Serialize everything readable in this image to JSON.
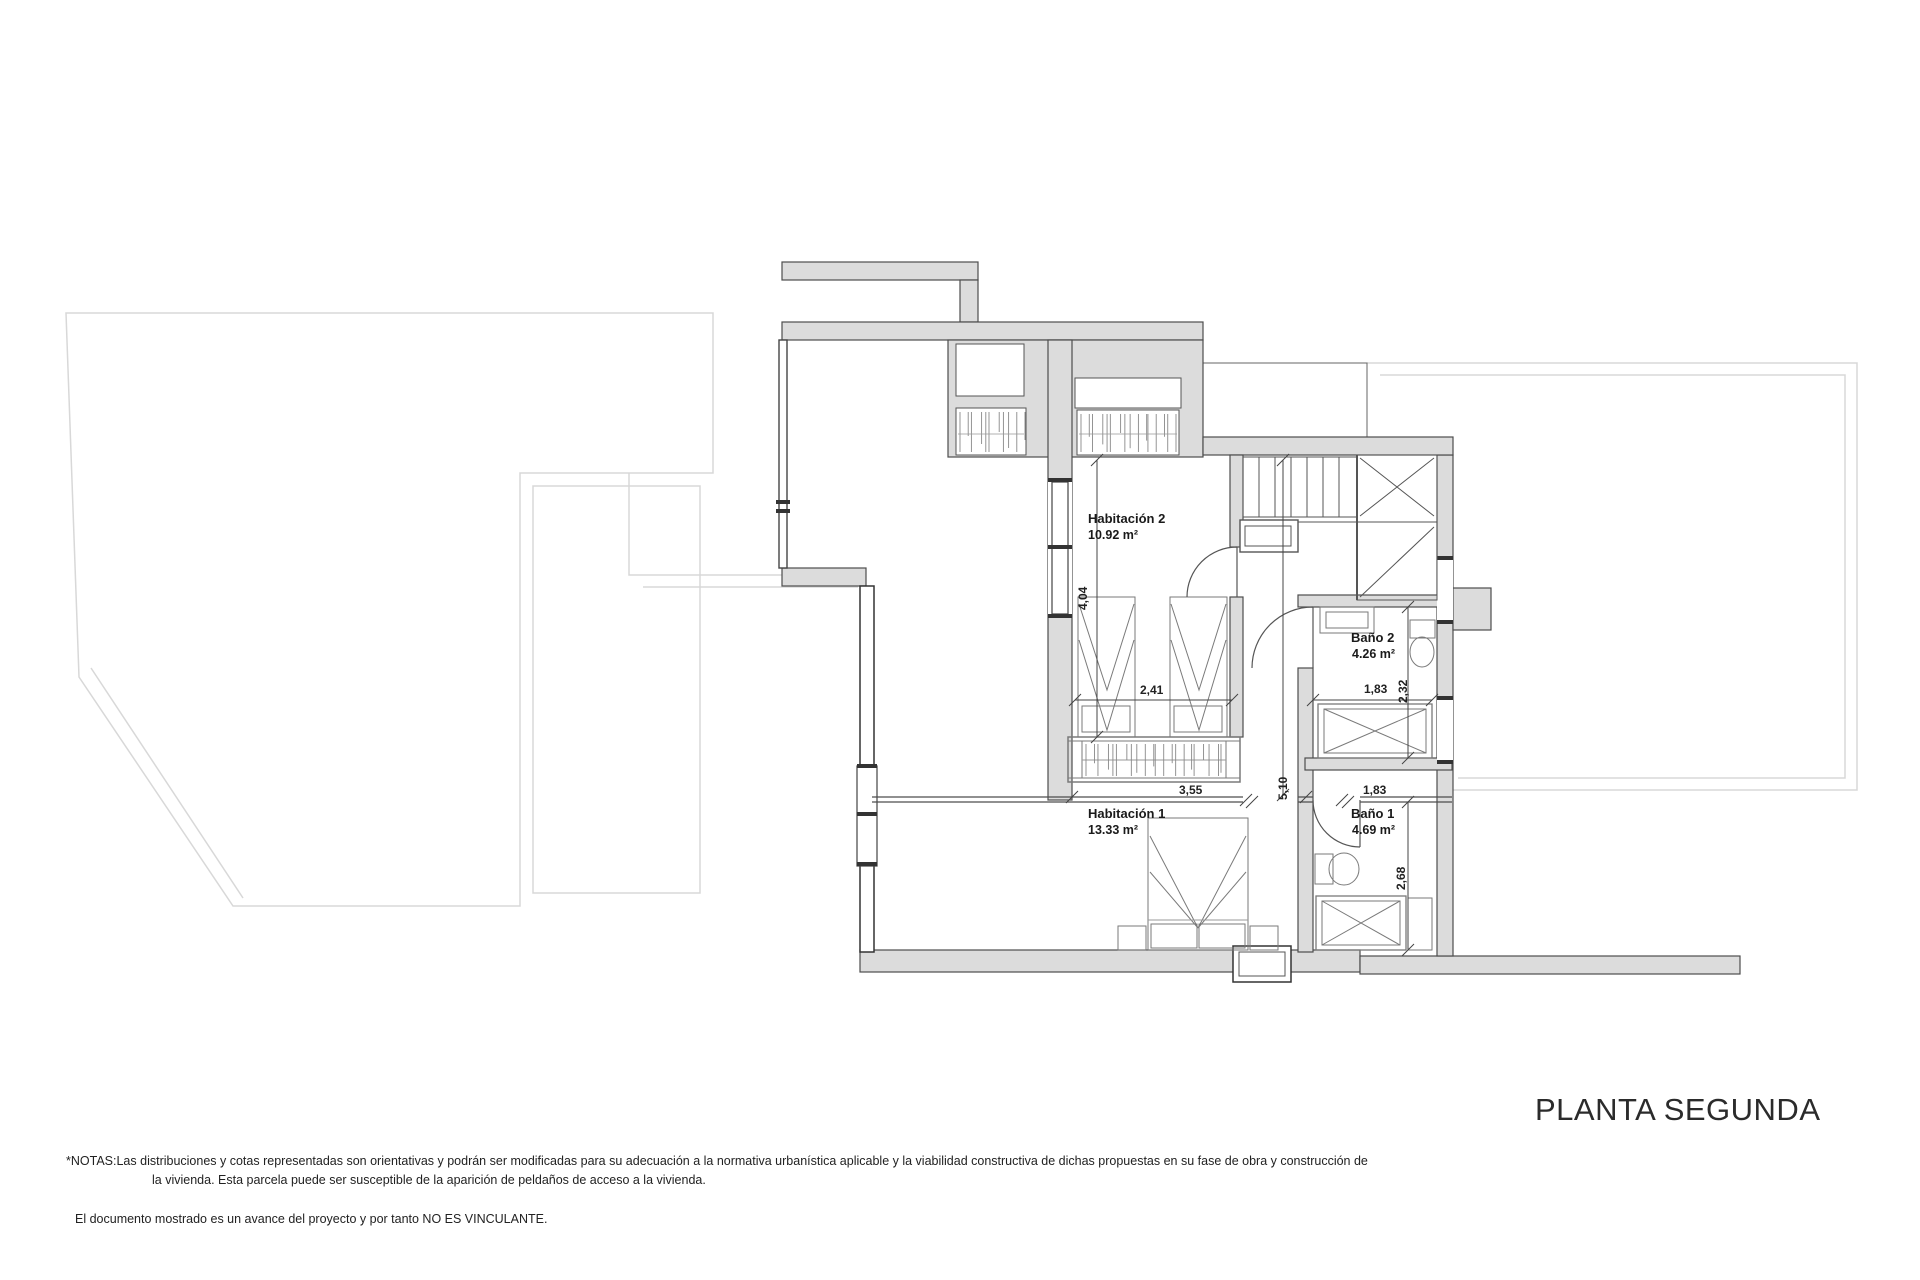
{
  "plan": {
    "title": "PLANTA SEGUNDA",
    "rooms": [
      {
        "name": "Habitación 2",
        "area": "10.92 m²"
      },
      {
        "name": "Habitación 1",
        "area": "13.33 m²"
      },
      {
        "name": "Baño 2",
        "area": "4.26 m²"
      },
      {
        "name": "Baño 1",
        "area": "4.69 m²"
      }
    ],
    "dimensions": {
      "hab2_height": "4,04",
      "hab2_width": "2,41",
      "hab2_closet_width": "3,55",
      "hall_length": "5,10",
      "bano2_width": "1,83",
      "bano2_depth": "2,32",
      "bano1_width": "1,83",
      "bano1_depth": "2,68"
    }
  },
  "footer": {
    "notes_label": "*NOTAS:",
    "notes_line1": "Las distribuciones y cotas representadas son orientativas y podrán ser modificadas para su adecuación a la normativa urbanística aplicable y la viabilidad constructiva de dichas propuestas en su fase de obra y construcción de",
    "notes_line2": "la vivienda. Esta parcela puede ser susceptible de la aparición de peldaños de acceso a la vivienda.",
    "disclaimer": "El documento mostrado es un avance del proyecto y por tanto NO ES VINCULANTE."
  },
  "colors": {
    "wall_fill": "#dcdcdc",
    "wall_stroke": "#4d4d4d",
    "faint_outline": "#d8d8d8",
    "furniture": "#7a7a7a",
    "text": "#1a1a1a"
  }
}
